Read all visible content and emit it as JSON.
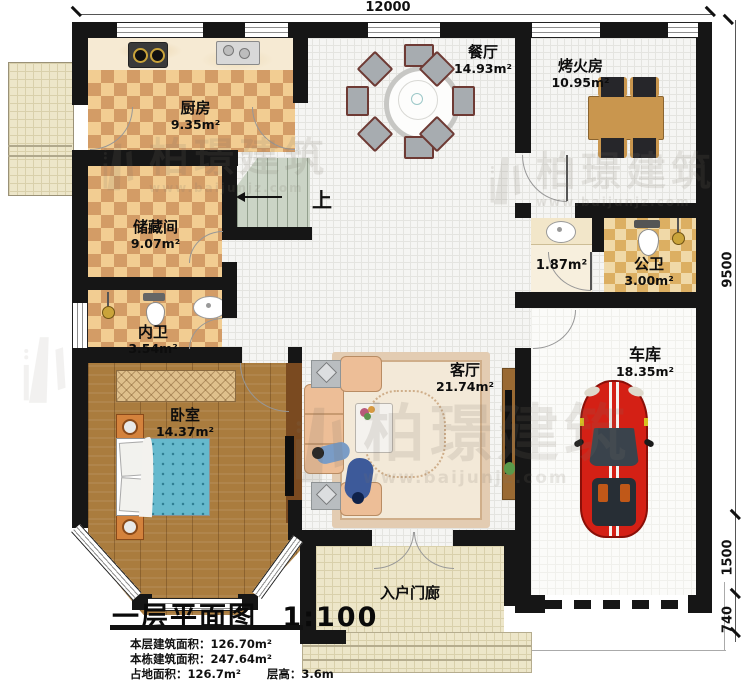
{
  "title": {
    "text": "一层平面图",
    "scale": "1:100"
  },
  "stats": [
    {
      "label": "本层建筑面积：",
      "value": "126.70m²"
    },
    {
      "label": "本栋建筑面积：",
      "value": "247.64m²"
    },
    {
      "label": "占地面积：",
      "value": "126.7m²"
    },
    {
      "label": "层高：",
      "value": "3.6m"
    }
  ],
  "dimensions": {
    "top": "12000",
    "right_main": "9500",
    "right_mid": "1500",
    "right_small": "740"
  },
  "stairs": {
    "direction_label": "上"
  },
  "rooms": {
    "kitchen": {
      "name": "厨房",
      "area": "9.35m²"
    },
    "dining": {
      "name": "餐厅",
      "area": "14.93m²"
    },
    "fire_room": {
      "name": "烤火房",
      "area": "10.95m²"
    },
    "storage": {
      "name": "储藏间",
      "area": "9.07m²"
    },
    "vestibule": {
      "area": "1.87m²"
    },
    "public_bath": {
      "name": "公卫",
      "area": "3.00m²"
    },
    "private_bath": {
      "name": "内卫",
      "area": "3.54m²"
    },
    "bedroom": {
      "name": "卧室",
      "area": "14.37m²"
    },
    "living": {
      "name": "客厅",
      "area": "21.74m²"
    },
    "garage": {
      "name": "车库",
      "area": "18.35m²"
    },
    "porch": {
      "name": "入户门廊"
    }
  },
  "watermark": {
    "brand": "柏璟建筑",
    "url": "www.baijunjz.com"
  },
  "colors": {
    "wall": "#161616",
    "checker_light": "#f2cd92",
    "checker_dark": "#d39c66",
    "wood": "#aa7c3e",
    "bed": "#66b9cd",
    "car": "#d42015",
    "stairs": "#cbd4c6",
    "porch_floor": "#ede6c9"
  }
}
